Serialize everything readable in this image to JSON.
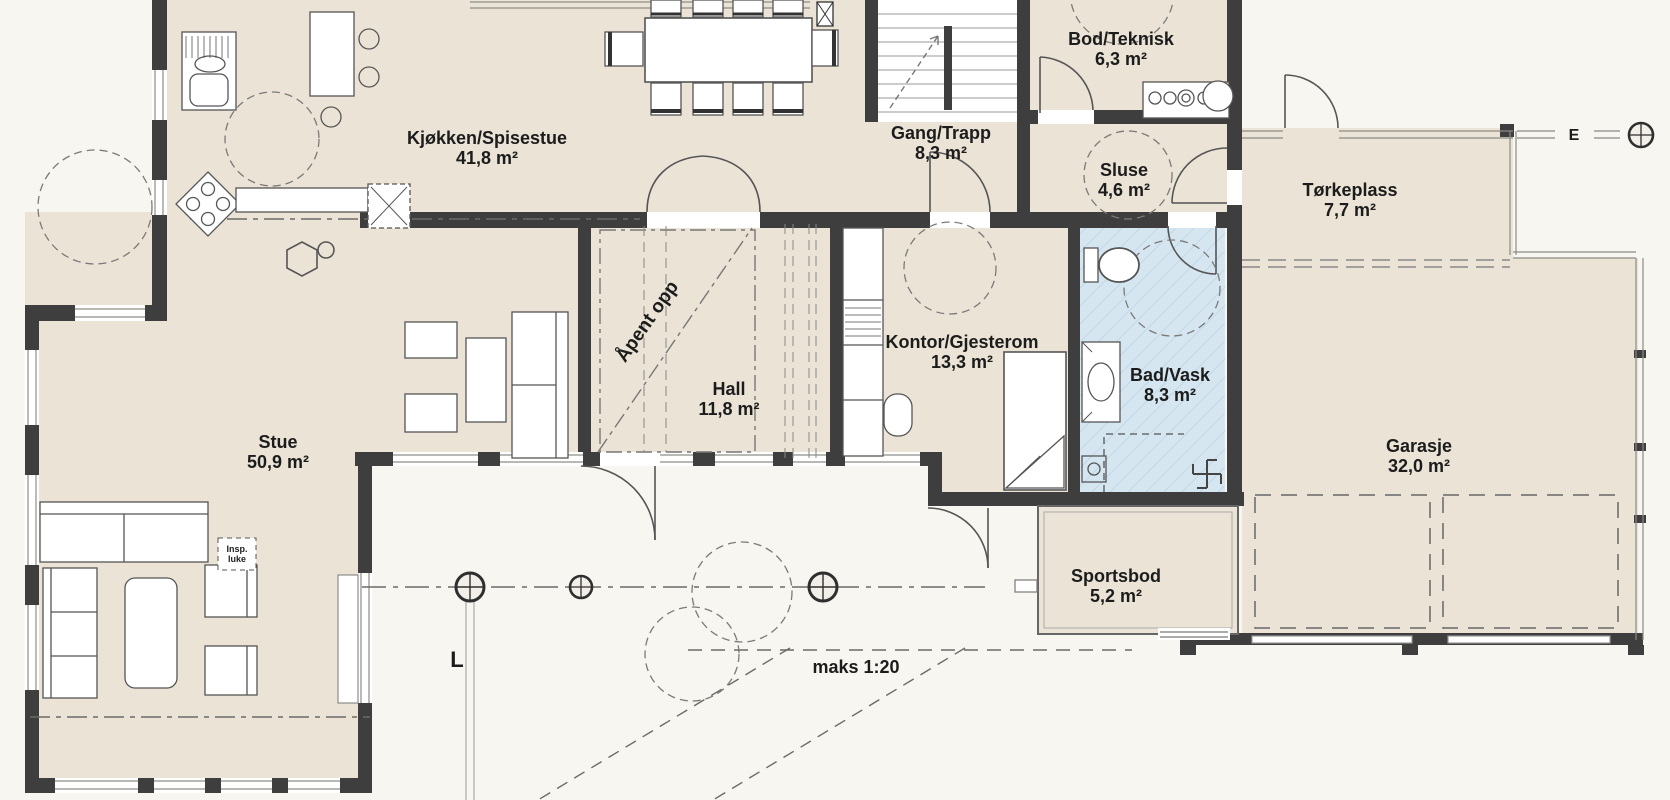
{
  "plan": {
    "rooms": [
      {
        "id": "kjokken-spisestue",
        "name": "Kjøkken/Spisestue",
        "area": "41,8 m²"
      },
      {
        "id": "gang-trapp",
        "name": "Gang/Trapp",
        "area": "8,3 m²"
      },
      {
        "id": "bod-teknisk",
        "name": "Bod/Teknisk",
        "area": "6,3 m²"
      },
      {
        "id": "sluse",
        "name": "Sluse",
        "area": "4,6 m²"
      },
      {
        "id": "torkeplass",
        "name": "Tørkeplass",
        "area": "7,7 m²"
      },
      {
        "id": "stue",
        "name": "Stue",
        "area": "50,9 m²"
      },
      {
        "id": "hall",
        "name": "Hall",
        "area": "11,8 m²"
      },
      {
        "id": "kontor-gjesterom",
        "name": "Kontor/Gjesterom",
        "area": "13,3 m²"
      },
      {
        "id": "bad-vask",
        "name": "Bad/Vask",
        "area": "8,3 m²"
      },
      {
        "id": "garasje",
        "name": "Garasje",
        "area": "32,0 m²"
      },
      {
        "id": "sportsbod",
        "name": "Sportsbod",
        "area": "5,2 m²"
      }
    ],
    "annotations": {
      "open_above": "Åpent opp",
      "scale_note": "maks 1:20",
      "inspection_hatch": {
        "line1": "Insp.",
        "line2": "luke"
      }
    },
    "grid_labels": {
      "l": "L",
      "e": "E"
    },
    "colors": {
      "room_fill": "#ebe4d6",
      "bath_fill": "#d5e6f0",
      "wall": "#3e3e3e",
      "background": "#f7f6f0"
    }
  }
}
